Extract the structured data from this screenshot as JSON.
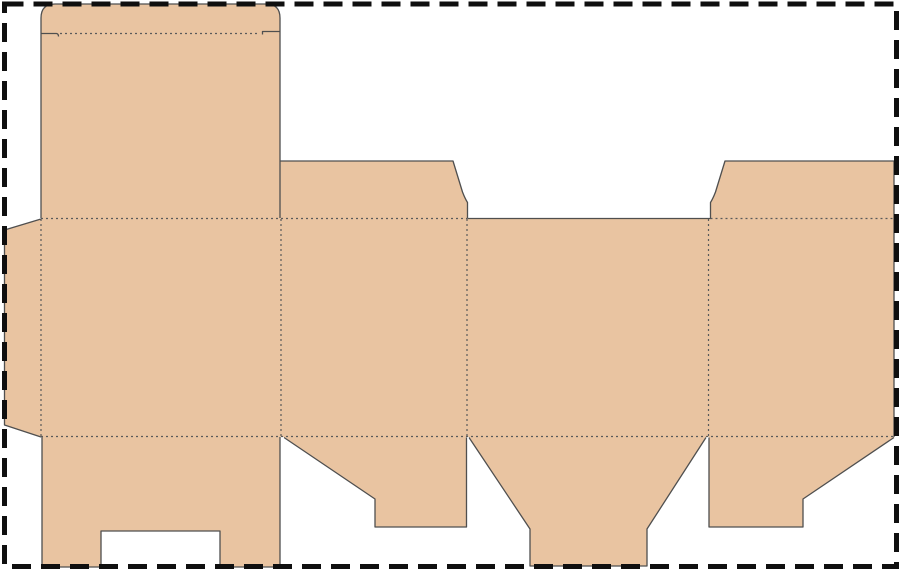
{
  "canvas": {
    "width": 900,
    "height": 571,
    "background": "#ffffff"
  },
  "colors": {
    "board_fill": "#e9c4a1",
    "cut_line": "#4f4f4f",
    "fold_line": "#5a5a5a",
    "artboard_border": "#0f0f0f"
  },
  "strokes": {
    "cut_width": 1.3,
    "fold_width": 1.2,
    "fold_dash": "2 3",
    "border_width": 5,
    "border_dash": "19 10"
  },
  "artboard_border": {
    "x": 4.5,
    "y": 4,
    "width": 892,
    "height": 562.5
  },
  "dieline": {
    "fills": [
      {
        "name": "glue-flap",
        "d": "M 41,219 L 41,437 L 4.5,425 L 4.5,230 Z"
      },
      {
        "name": "body-panels",
        "d": "M 41,218 L 894,218 L 894,437 L 41,437 Z"
      },
      {
        "name": "lid-panel",
        "d": "M 41,218 L 41,18 Q 41,4 55,4 L 266,4 Q 280,4 280,18 L 280,218 Z"
      },
      {
        "name": "dust-flap-left",
        "d": "M 280,218.5 L 280,161 L 453,161 L 462.5,192 Q 465,198.5 467.5,202.5 L 467.5,218.5 Z"
      },
      {
        "name": "dust-flap-right",
        "d": "M 710.5,218.5 L 710.5,202.5 Q 713,198.5 715.5,192 L 725,161 L 894,161 L 894,218.5 Z"
      },
      {
        "name": "bottom-flap-back",
        "d": "M 42,437 L 280,437 L 280,567 L 220,567 L 220,531 L 101,531 L 101,567 L 42,567 Z"
      },
      {
        "name": "bottom-flap-side-left",
        "d": "M 284,437 L 466.5,437 L 466.5,527 L 375,527 L 375,499 Z"
      },
      {
        "name": "bottom-flap-front",
        "d": "M 469,437 L 706,437 L 647,529 L 647,566 L 530,566 L 530,529 Z"
      },
      {
        "name": "bottom-flap-side-right",
        "d": "M 709,437 L 894,437 L 803,499 L 803,527 L 709,527 Z"
      }
    ],
    "cuts": [
      {
        "name": "lid-outline-cut",
        "d": "M 41,218 L 41,18 Q 41,4 55,4 L 266,4 Q 280,4 280,18 L 280,218"
      },
      {
        "name": "tuck-slit-left-cut",
        "d": "M 41,33.5 L 56.5,33.5 Q 58.5,33.8 58.5,36.5"
      },
      {
        "name": "tuck-slit-right-cut",
        "d": "M 280,31.5 L 262.5,31.5 L 262.5,34.5"
      },
      {
        "name": "glue-flap-cut",
        "d": "M 41,219 L 4.5,230 L 4.5,425 L 41,437"
      },
      {
        "name": "dust-flap-left-cut",
        "d": "M 280,161 L 453,161 L 462.5,192 Q 465,198.5 467.5,202.5 L 467.5,218.5"
      },
      {
        "name": "front-panel-top-cut",
        "d": "M 467.5,218.5 L 710.5,218.5"
      },
      {
        "name": "dust-flap-right-cut",
        "d": "M 710.5,218.5 L 710.5,202.5 Q 713,198.5 715.5,192 L 725,161 L 894,161 L 894,437"
      },
      {
        "name": "bottom-flap-back-cut",
        "d": "M 42,437 L 42,567 L 101,567 L 101,531 L 220,531 L 220,567 L 280,567 L 280,437"
      },
      {
        "name": "bottom-flap-side-left-cut",
        "d": "M 284,437.5 L 375,499 L 375,527 L 466.5,527 L 466.5,437.5"
      },
      {
        "name": "bottom-flap-front-cut",
        "d": "M 469,437.5 L 530,529 L 530,566 L 647,566 L 647,529 L 706,437.5"
      },
      {
        "name": "bottom-flap-side-right-cut",
        "d": "M 709,437.5 L 709,527 L 803,527 L 803,499 L 894,437.5"
      }
    ],
    "folds": [
      {
        "name": "tuck-flap-fold",
        "x1": 60,
        "y1": 33.5,
        "x2": 260,
        "y2": 33.5
      },
      {
        "name": "top-fold-left",
        "x1": 41,
        "y1": 218.5,
        "x2": 467,
        "y2": 218.5
      },
      {
        "name": "top-fold-right",
        "x1": 710.5,
        "y1": 218.5,
        "x2": 894,
        "y2": 218.5
      },
      {
        "name": "bottom-fold",
        "x1": 41,
        "y1": 436.5,
        "x2": 894,
        "y2": 436.5
      },
      {
        "name": "glue-flap-fold",
        "x1": 41,
        "y1": 219,
        "x2": 41,
        "y2": 437
      },
      {
        "name": "panel1-panel2-fold",
        "x1": 281,
        "y1": 219,
        "x2": 281,
        "y2": 437
      },
      {
        "name": "panel2-panel3-fold",
        "x1": 467,
        "y1": 219,
        "x2": 467,
        "y2": 437
      },
      {
        "name": "panel3-panel4-fold",
        "x1": 708.5,
        "y1": 219,
        "x2": 708.5,
        "y2": 437
      }
    ]
  }
}
